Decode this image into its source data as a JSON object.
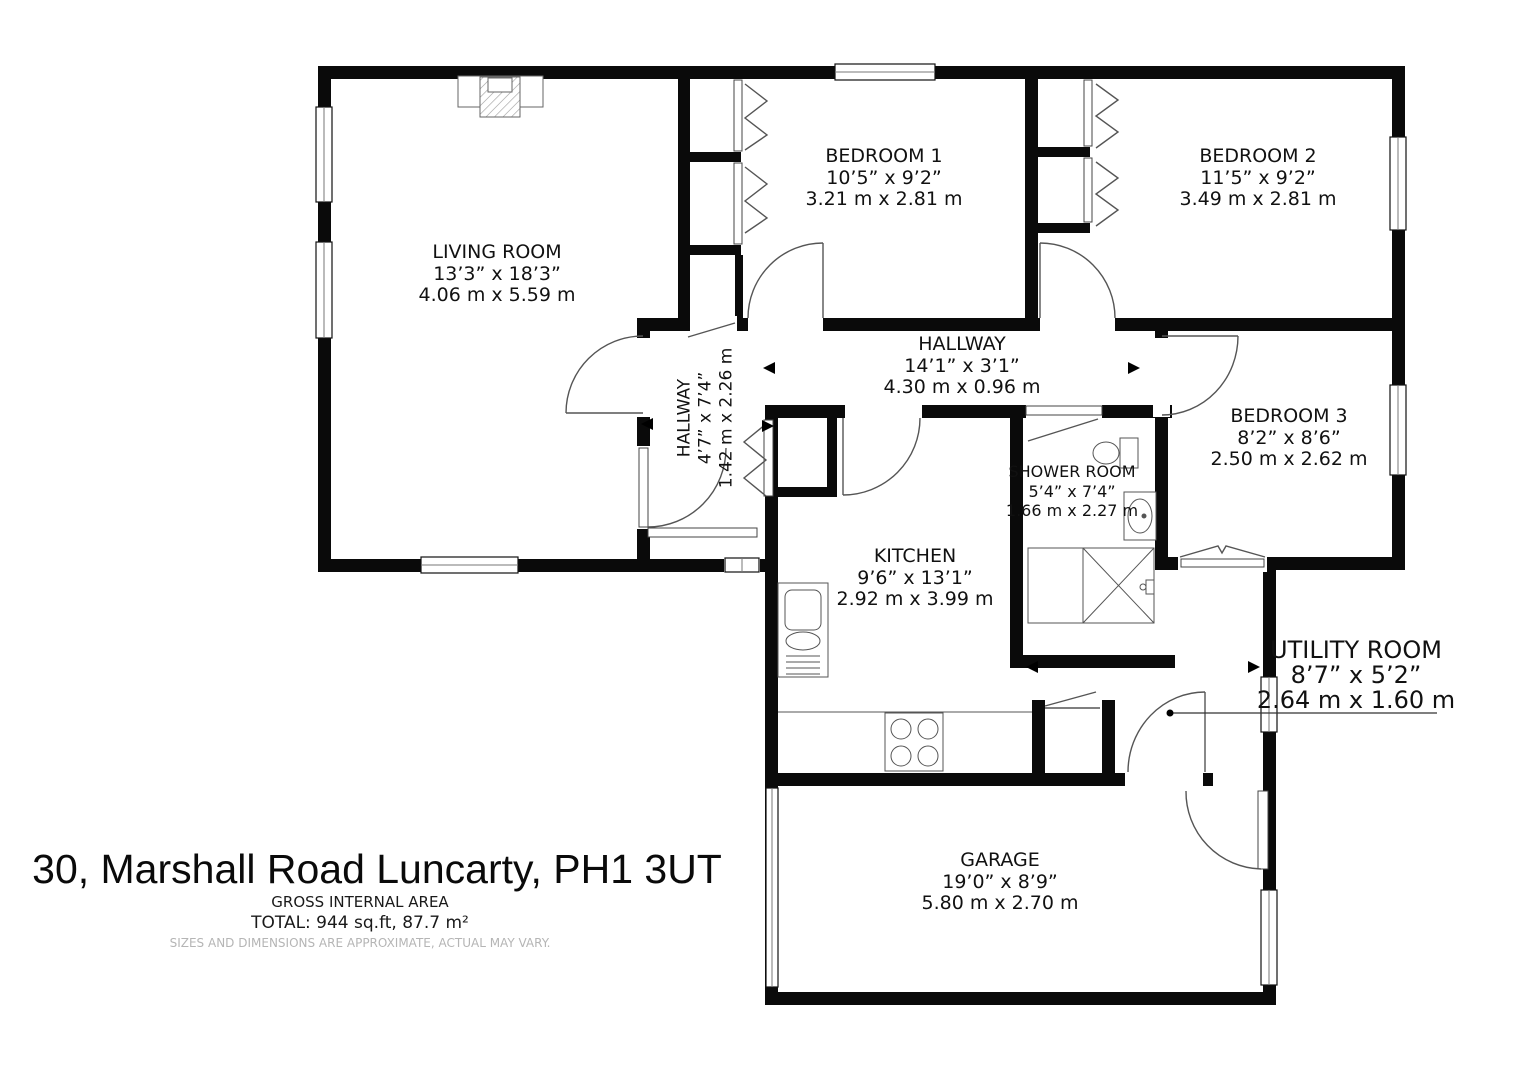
{
  "title": "30, Marshall Road Luncarty, PH1 3UT",
  "area": {
    "heading": "GROSS INTERNAL AREA",
    "total": "TOTAL: 944 sq.ft, 87.7 m²",
    "disclaimer": "SIZES AND DIMENSIONS ARE APPROXIMATE, ACTUAL MAY VARY."
  },
  "rooms": {
    "living_room": {
      "name": "LIVING ROOM",
      "imperial": "13’3” x 18’3”",
      "metric": "4.06 m x 5.59 m"
    },
    "bedroom1": {
      "name": "BEDROOM 1",
      "imperial": "10’5” x 9’2”",
      "metric": "3.21 m x 2.81 m"
    },
    "bedroom2": {
      "name": "BEDROOM 2",
      "imperial": "11’5” x 9’2”",
      "metric": "3.49 m x 2.81 m"
    },
    "bedroom3": {
      "name": "BEDROOM 3",
      "imperial": "8’2” x 8’6”",
      "metric": "2.50 m x 2.62 m"
    },
    "hallway": {
      "name": "HALLWAY",
      "imperial": "14’1” x 3’1”",
      "metric": "4.30 m x 0.96 m"
    },
    "hallway_small": {
      "name": "HALLWAY",
      "imperial": "4’7” x 7’4”",
      "metric": "1.42 m x 2.26 m"
    },
    "shower_room": {
      "name": "SHOWER ROOM",
      "imperial": "5’4” x 7’4”",
      "metric": "1.66 m x 2.27 m"
    },
    "kitchen": {
      "name": "KITCHEN",
      "imperial": "9’6” x 13’1”",
      "metric": "2.92 m x 3.99 m"
    },
    "utility_room": {
      "name": "UTILITY ROOM",
      "imperial": "8’7” x 5’2”",
      "metric": "2.64 m x 1.60 m"
    },
    "garage": {
      "name": "GARAGE",
      "imperial": "19’0” x 8’9”",
      "metric": "5.80 m x 2.70 m"
    }
  }
}
